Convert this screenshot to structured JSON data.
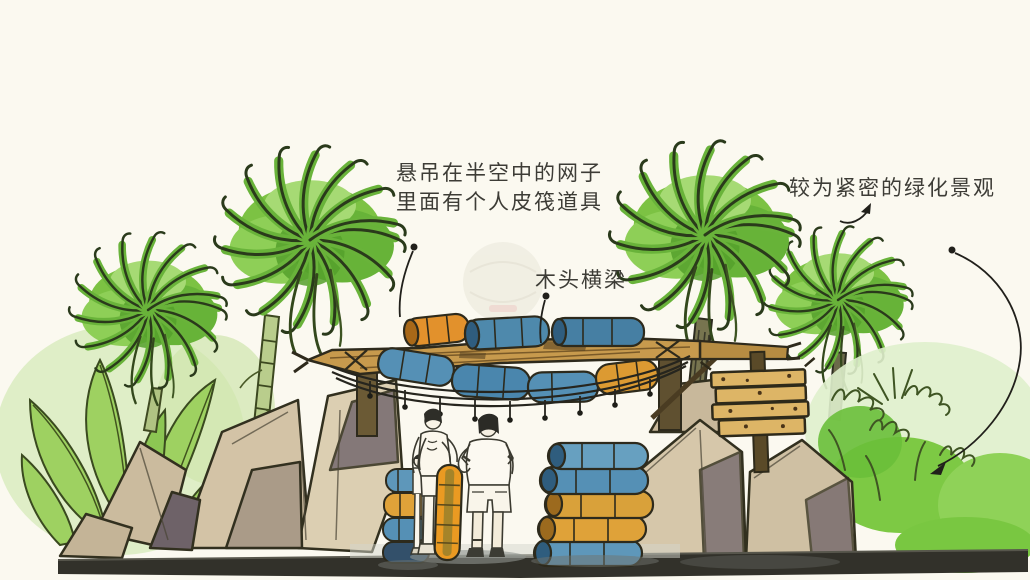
{
  "scene": {
    "description": "Hand-drawn watercolor concept sketch of a water-park entrance gate: palm trees, rock piles, stacked rafts, a rope net hanging from a wooden beam, a wooden plank sign and two human figures",
    "background_color": "#fbf9f0",
    "ink_color": "#2d2c24",
    "palette": {
      "palm_green": "#7cc243",
      "palm_green_dark": "#55a02c",
      "foliage_light": "#a8d76d",
      "rock_tan": "#d2c2a5",
      "rock_shadow": "#6e6268",
      "beam_wood": "#c79a4d",
      "sign_wood": "#ddb566",
      "raft_blue": "#5590b5",
      "raft_orange": "#e09a33",
      "ground_dark": "#32312a"
    }
  },
  "annotations": {
    "net": {
      "line1": "悬吊在半空中的网子",
      "line2": "里面有个人皮筏道具"
    },
    "beam": {
      "text": "木头横梁"
    },
    "greenery": {
      "text": "较为紧密的绿化景观"
    }
  }
}
